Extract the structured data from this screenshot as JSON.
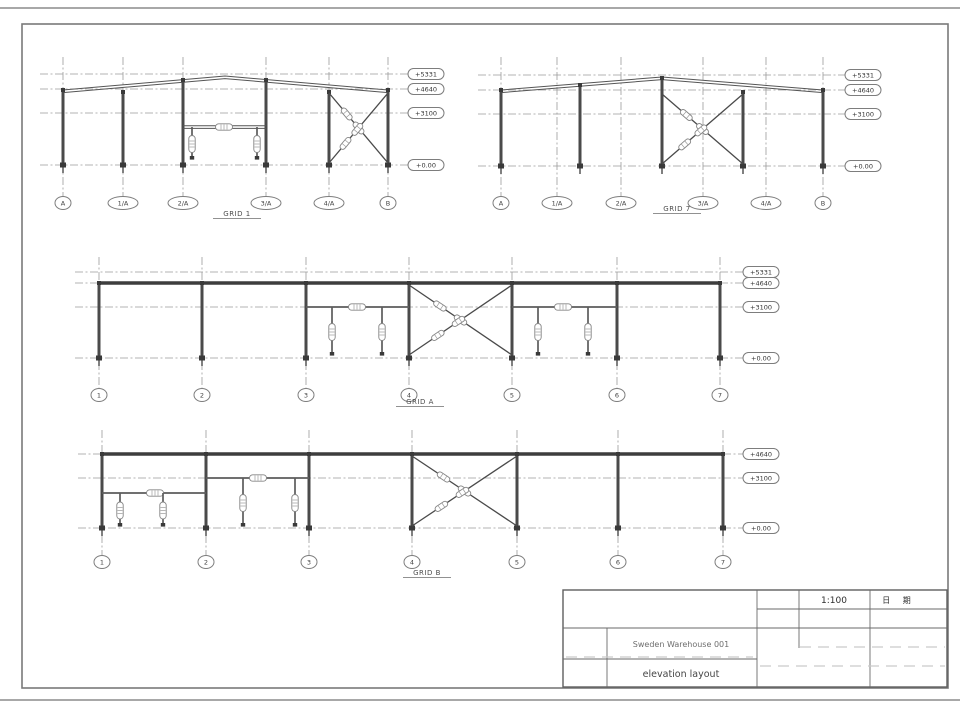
{
  "sheet": {
    "views": [
      {
        "id": "grid-1",
        "title": "GRID 1",
        "grid_labels": [
          "A",
          "1/A",
          "2/A",
          "3/A",
          "4/A",
          "B"
        ],
        "elevation_labels": [
          "+5331",
          "+4640",
          "+3100",
          "+0.00"
        ]
      },
      {
        "id": "grid-7",
        "title": "GRID 7",
        "grid_labels": [
          "A",
          "1/A",
          "2/A",
          "3/A",
          "4/A",
          "B"
        ],
        "elevation_labels": [
          "+5331",
          "+4640",
          "+3100",
          "+0.00"
        ]
      },
      {
        "id": "grid-a",
        "title": "GRID A",
        "grid_labels": [
          "1",
          "2",
          "3",
          "4",
          "5",
          "6",
          "7"
        ],
        "elevation_labels": [
          "+5331",
          "+4640",
          "+3100",
          "+0.00"
        ]
      },
      {
        "id": "grid-b",
        "title": "GRID B",
        "grid_labels": [
          "1",
          "2",
          "3",
          "4",
          "5",
          "6",
          "7"
        ],
        "elevation_labels": [
          "+4640",
          "+3100",
          "+0.00"
        ]
      }
    ],
    "title_block": {
      "scale": "1:100",
      "date_label": "日 期",
      "project": "Sweden Warehouse 001",
      "drawing_title": "elevation layout"
    },
    "colors": {
      "structure_line": "#4a4a4a",
      "centerline": "#9b9b9b",
      "background": "#ffffff"
    }
  }
}
